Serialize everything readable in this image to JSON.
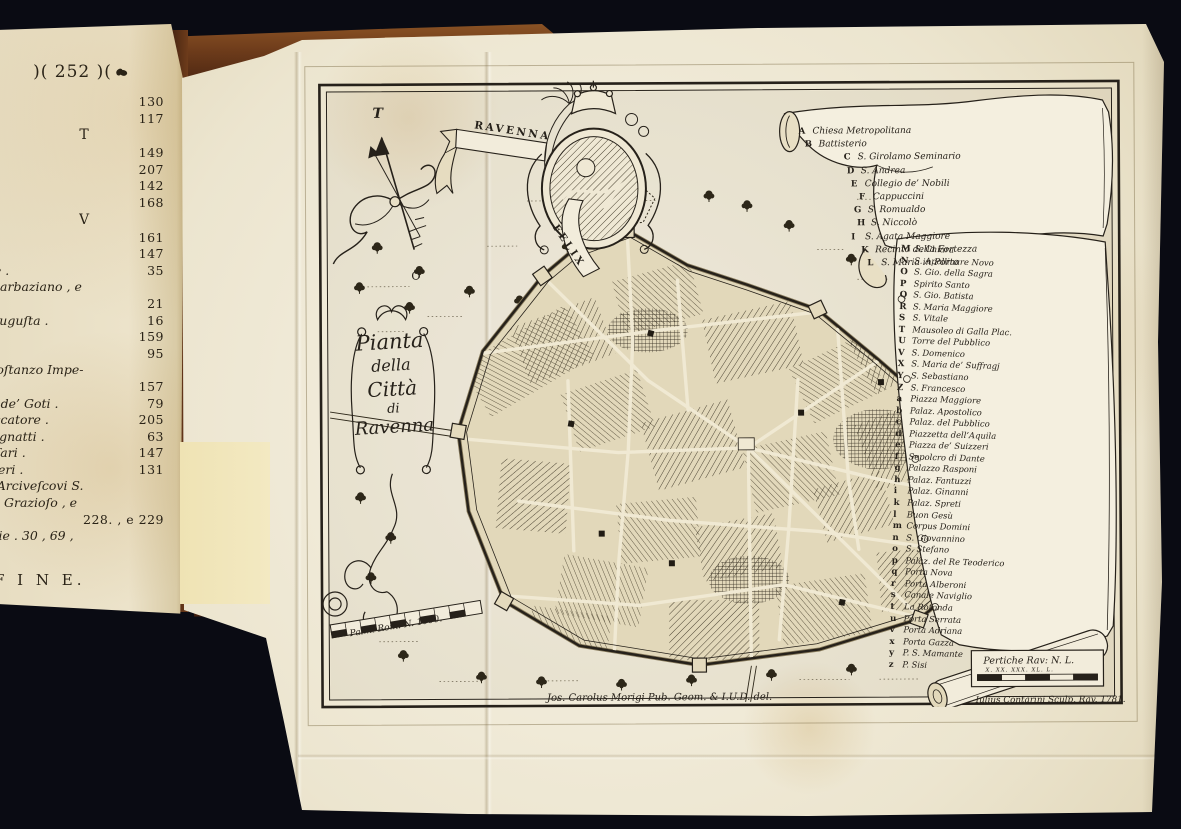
{
  "photo": {
    "background_color": "#0a0b13",
    "paper_color": "#efe9d6",
    "ink_color": "#26211a",
    "cover_color": "#7b4423"
  },
  "book_page": {
    "header": ")( 252 )(",
    "lines": [
      {
        "type": "entry",
        "text": "",
        "page": "130"
      },
      {
        "type": "entry",
        "text": "ſa .",
        "page": "117"
      },
      {
        "type": "section",
        "text": "T",
        "page": ""
      },
      {
        "type": "entry",
        "text": "co .",
        "page": "149"
      },
      {
        "type": "entry",
        "text": "o fuori .",
        "page": "207"
      },
      {
        "type": "entry",
        "text": "lico .",
        "page": "142"
      },
      {
        "type": "entry",
        "text": "tuno .",
        "page": "168"
      },
      {
        "type": "section",
        "text": "V",
        "page": ""
      },
      {
        "type": "entry",
        "text": "",
        "page": "161"
      },
      {
        "type": "entry",
        "text": "",
        "page": "147"
      },
      {
        "type": "entry",
        "text": "ria gentile .",
        "page": "35"
      },
      {
        "type": "entry",
        "text": "ale di S. Barbaziano , e",
        "page": ""
      },
      {
        "type": "entry",
        "text": "inaldo .",
        "page": "21"
      },
      {
        "type": "entry",
        "text": "Placidia Auguſta .",
        "page": "16"
      },
      {
        "type": "entry",
        "text": "o Eſarca .",
        "page": "159"
      },
      {
        "type": "entry",
        "text": "Numai .",
        "page": "95"
      },
      {
        "type": "entry",
        "text": "io , e di Coſtanzo Impe-",
        "page": ""
      },
      {
        "type": "entry",
        "text": "",
        "page": "157"
      },
      {
        "type": "entry",
        "text": "derico Re de’ Goti .",
        "page": "79"
      },
      {
        "type": "entry",
        "text": "Pietro Peccatore .",
        "page": "205"
      },
      {
        "type": "entry",
        "text": "amiglia Pignatti .",
        "page": "63"
      },
      {
        "type": "entry",
        "text": "ro Traverſari .",
        "page": "147"
      },
      {
        "type": "entry",
        "text": "ſig. Ruggieri .",
        "page": "131"
      },
      {
        "type": "entry",
        "text": "rali degli Arciveſcovi S.",
        "page": ""
      },
      {
        "type": "entry",
        "text": "Giovanni , Grazioſo , e",
        "page": ""
      },
      {
        "type": "entry",
        "text": "oro .",
        "page": "228. , e 229"
      },
      {
        "type": "entry",
        "text": "ne Famiglie . 30 , 69 ,",
        "page": ""
      },
      {
        "type": "entry",
        "text": "e altrove .",
        "page": ""
      },
      {
        "type": "fine",
        "text": "F I N E.",
        "page": ""
      }
    ]
  },
  "plate": {
    "banner_ribbon": "RAVENNA",
    "motto_ribbon": "FELIX",
    "compass": {
      "north_label": "T",
      "south_label": "O"
    },
    "title_lines": [
      {
        "t": "Pianta"
      },
      {
        "t": "della"
      },
      {
        "t": "Città"
      },
      {
        "t": "di"
      },
      {
        "t": "Ravenna"
      }
    ],
    "legend_upper": [
      {
        "key": "A",
        "name": "Chiesa Metropolitana"
      },
      {
        "key": "B",
        "name": "Battisterio"
      },
      {
        "key": "C",
        "name": "S. Girolamo Seminario"
      },
      {
        "key": "D",
        "name": "S. Andrea"
      },
      {
        "key": "E",
        "name": "Collegio de’ Nobili"
      },
      {
        "key": "F",
        "name": "Cappuccini"
      },
      {
        "key": "G",
        "name": "S. Romualdo"
      },
      {
        "key": "H",
        "name": "S. Niccolò"
      },
      {
        "key": "I",
        "name": "S. Agata Maggiore"
      },
      {
        "key": "K",
        "name": "Recinto della Fortezza"
      },
      {
        "key": "L",
        "name": "S. Maria in Porto"
      }
    ],
    "legend_lower": [
      {
        "key": "M",
        "name": "S. Chiara"
      },
      {
        "key": "N",
        "name": "S. Apollinare Novo"
      },
      {
        "key": "O",
        "name": "S. Gio. della Sagra"
      },
      {
        "key": "P",
        "name": "Spirito Santo"
      },
      {
        "key": "Q",
        "name": "S. Gio. Batista"
      },
      {
        "key": "R",
        "name": "S. Maria Maggiore"
      },
      {
        "key": "S",
        "name": "S. Vitale"
      },
      {
        "key": "T",
        "name": "Mausoleo di Galla Plac."
      },
      {
        "key": "U",
        "name": "Torre del Pubblico"
      },
      {
        "key": "V",
        "name": "S. Domenico"
      },
      {
        "key": "X",
        "name": "S. Maria de’ Suffragj"
      },
      {
        "key": "Y",
        "name": "S. Sebastiano"
      },
      {
        "key": "Z",
        "name": "S. Francesco"
      },
      {
        "key": "a",
        "name": "Piazza Maggiore"
      },
      {
        "key": "b",
        "name": "Palaz. Apostolico"
      },
      {
        "key": "c",
        "name": "Palaz. del Pubblico"
      },
      {
        "key": "d",
        "name": "Piazzetta dell’Aquila"
      },
      {
        "key": "e",
        "name": "Piazza de’ Suizzeri"
      },
      {
        "key": "f",
        "name": "Sepolcro di Dante"
      },
      {
        "key": "g",
        "name": "Palazzo Rasponi"
      },
      {
        "key": "h",
        "name": "Palaz. Fantuzzi"
      },
      {
        "key": "i",
        "name": "Palaz. Ginanni"
      },
      {
        "key": "k",
        "name": "Palaz. Spreti"
      },
      {
        "key": "l",
        "name": "Buon Gesù"
      },
      {
        "key": "m",
        "name": "Corpus Domini"
      },
      {
        "key": "n",
        "name": "S. Giovannino"
      },
      {
        "key": "o",
        "name": "S. Stefano"
      },
      {
        "key": "p",
        "name": "Palaz. del Re Teoderico"
      },
      {
        "key": "q",
        "name": "Porta Nova"
      },
      {
        "key": "r",
        "name": "Porta Alberoni"
      },
      {
        "key": "s",
        "name": "Canale Naviglio"
      },
      {
        "key": "t",
        "name": "La Rotonda"
      },
      {
        "key": "u",
        "name": "Porta Serrata"
      },
      {
        "key": "v",
        "name": "Porta Adriana"
      },
      {
        "key": "x",
        "name": "Porta Gazza"
      },
      {
        "key": "y",
        "name": "P. S. Mamante"
      },
      {
        "key": "z",
        "name": "P. Sisi"
      }
    ],
    "scale_left_label": "Palmi Rom: N. 1000.",
    "scale_right_label": "Pertiche Rav: N. L.",
    "scale_right_ticks": "X.  XX.  XXX.  XL.  L.",
    "credit_delineator": "Jos. Carolus Morigi Pub. Geom. & I.U.D. del.",
    "credit_engraver": "Iulius Contarini Sculp. Rav. 1781."
  }
}
